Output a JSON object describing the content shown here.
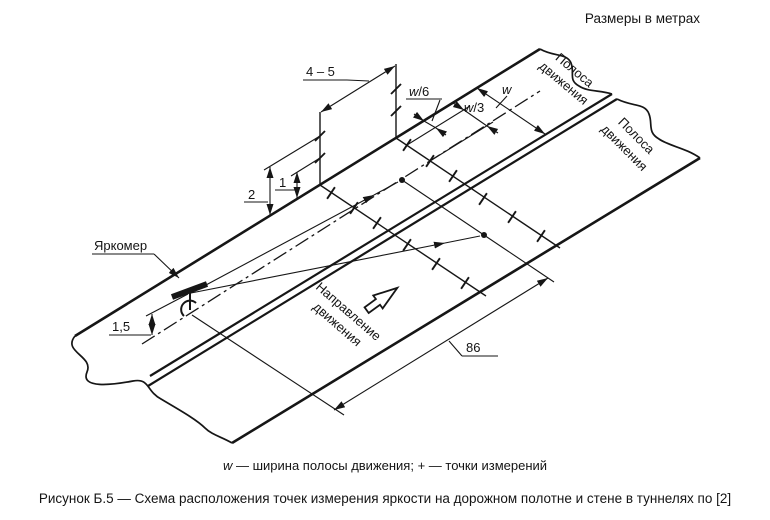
{
  "units_note": "Размеры в метрах",
  "diagram": {
    "lane1": {
      "line1": "Полоса",
      "line2": "движения"
    },
    "lane2": {
      "line1": "Полоса",
      "line2": "движения"
    },
    "direction": {
      "line1": "Направление",
      "line2": "движения"
    },
    "meter_label": "Яркомер",
    "dims": {
      "spacing": "4 – 5",
      "height2": "2",
      "height1": "1",
      "meter_height": "1,5",
      "w_sym": "w",
      "w6_suffix": "/6",
      "w3_suffix": "/3",
      "field_length": "86"
    }
  },
  "legend": {
    "w_sym": "w",
    "rest": " — ширина полосы движения; + — точки измерений"
  },
  "caption": "Рисунок Б.5 — Схема расположения точек измерения яркости на дорожном полотне и стене в туннелях по [2]"
}
